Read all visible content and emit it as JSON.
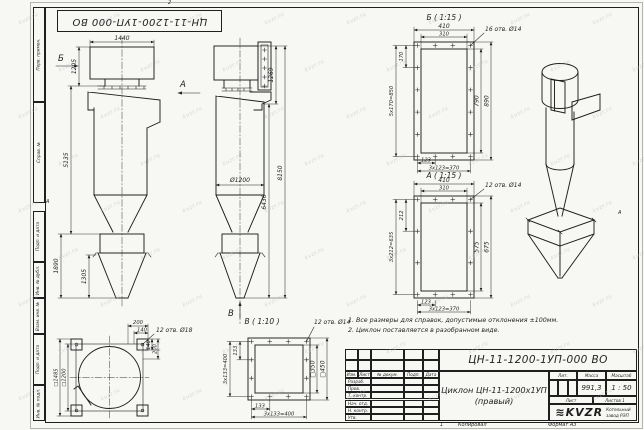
{
  "page": {
    "colors": {
      "paper": "#f7f7f4",
      "ink": "#1f1f1f",
      "wm": "#b3bebd"
    }
  },
  "watermark": "kvzr.ru",
  "frame": {
    "stamp_designation": "ЦН-11-1200-1УП-000 ВО",
    "margin_labels": [
      "Перв. примен.",
      "Справ. №",
      "Подп. и дата",
      "Инв. № дубл.",
      "Взам. инв. №",
      "Подп. и дата",
      "Инв. № подл."
    ],
    "zone_top": "2",
    "zone_a_left": "А",
    "zone_a_right": "А"
  },
  "views": {
    "front": {
      "label_b": "Б",
      "label_a": "А",
      "dims": {
        "w_top": "1440",
        "h_inlet": "1205",
        "h_body": "5135",
        "h_bunker": "1890",
        "h_cone": "1305"
      }
    },
    "side": {
      "label_v": "В",
      "dims": {
        "d_body": "Ø1200",
        "h_head": "1269",
        "h_lower": "6436",
        "h_total": "8150"
      }
    },
    "detail_b": {
      "title": "Б ( 1:15 )",
      "callout": "16 отв. Ø14",
      "dims": {
        "w_out": "410",
        "w_in": "310",
        "pitch": "170",
        "pitch_sum": "5x170=850",
        "h_in": "790",
        "h_out": "890",
        "pitch_b": "123",
        "pitch_b_sum": "3x123=370"
      }
    },
    "detail_a": {
      "title": "А ( 1:15 )",
      "callout": "12 отв. Ø14",
      "dims": {
        "w_out": "410",
        "w_in": "310",
        "pitch": "212",
        "pitch_sum": "3x212=635",
        "h_in": "575",
        "h_out": "675",
        "pitch_b": "123",
        "pitch_b_sum": "3x123=370"
      }
    },
    "detail_v": {
      "title": "В ( 1:10 )",
      "callout": "12 отв. Ø14",
      "dims": {
        "pitch_l": "133",
        "pitch_l_sum": "3x133=400",
        "sq_in": "□350",
        "sq_out": "□450",
        "pitch_b": "133",
        "pitch_b_sum": "3x133=400"
      }
    },
    "top": {
      "callout": "12 отв. Ø18",
      "dims": {
        "off_200": "200",
        "off_140": "140",
        "sq_out": "□1485",
        "sq_in": "□1200",
        "r_140": "140",
        "r_200": "200"
      }
    }
  },
  "notes": [
    "1. Все размеры для справок, допустимые отклонения ±100мм.",
    "2. Циклон поставляется в разобранном виде."
  ],
  "title_block": {
    "designation": "ЦН-11-1200-1УП-000 ВО",
    "name_line1": "Циклон ЦН-11-1200х1УП",
    "name_line2": "(правый)",
    "cols": {
      "izm": "Изм.",
      "list": "Лист",
      "doc": "№ докум.",
      "podp": "Подп.",
      "data": "Дата"
    },
    "roles": [
      "Разраб.",
      "Пров.",
      "Т. контр.",
      "Нач. отд.",
      "Н. контр.",
      "Утв."
    ],
    "lit": "Лит.",
    "mass": "Масса",
    "scale": "Масштаб",
    "mass_value": "991,3",
    "scale_value": "1 : 50",
    "sheet": "Лист",
    "sheets": "Листов",
    "sheets_value": "1",
    "logo_icon": "≋",
    "logo": "KVZR",
    "company": [
      "Котельный",
      "завод РЭП"
    ]
  },
  "footer": {
    "copy": "Копировал",
    "format": "Формат А3",
    "num": "1"
  }
}
